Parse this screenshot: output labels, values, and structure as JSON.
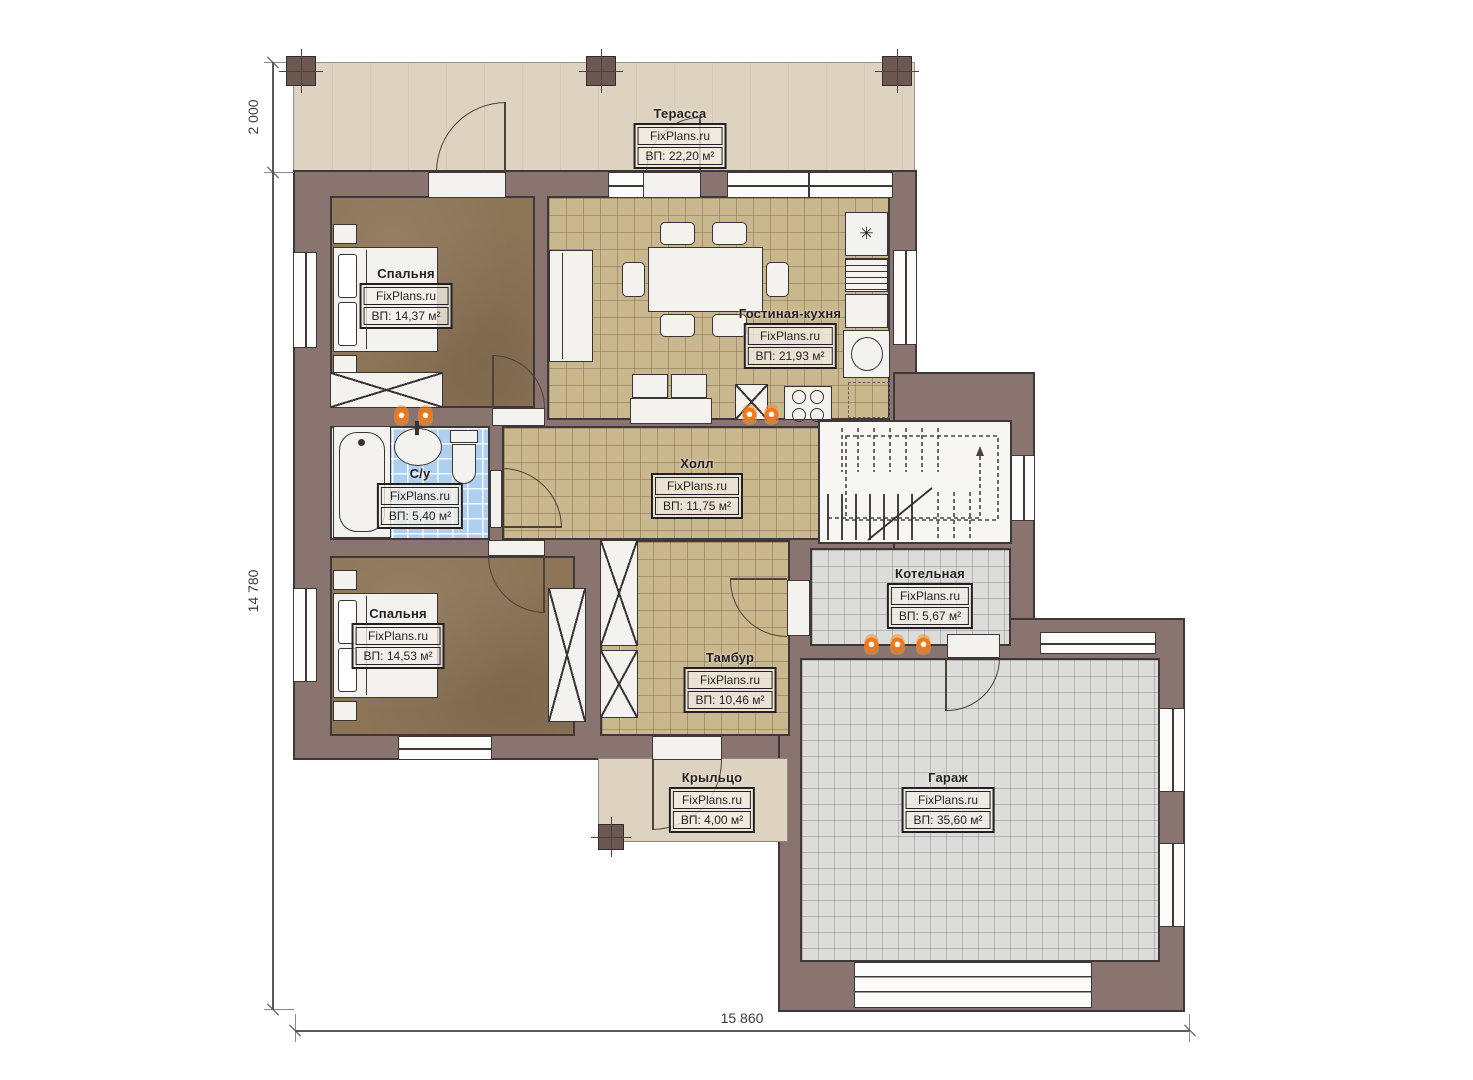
{
  "plan": {
    "type": "floor-plan",
    "language": "ru",
    "brand": "FixPlans.ru"
  },
  "rooms": {
    "terrace": {
      "name": "Терасса",
      "brand": "FixPlans.ru",
      "area": "ВП: 22,20 м²"
    },
    "bedroom1": {
      "name": "Спальня",
      "brand": "FixPlans.ru",
      "area": "ВП: 14,37 м²"
    },
    "living_kitchen": {
      "name": "Гостиная-кухня",
      "brand": "FixPlans.ru",
      "area": "ВП: 21,93 м²"
    },
    "bathroom": {
      "name": "С/у",
      "brand": "FixPlans.ru",
      "area": "ВП: 5,40 м²"
    },
    "hall": {
      "name": "Холл",
      "brand": "FixPlans.ru",
      "area": "ВП: 11,75 м²"
    },
    "bedroom2": {
      "name": "Спальня",
      "brand": "FixPlans.ru",
      "area": "ВП: 14,53 м²"
    },
    "boiler": {
      "name": "Котельная",
      "brand": "FixPlans.ru",
      "area": "ВП: 5,67 м²"
    },
    "vestibule": {
      "name": "Тамбур",
      "brand": "FixPlans.ru",
      "area": "ВП: 10,46 м²"
    },
    "porch": {
      "name": "Крыльцо",
      "brand": "FixPlans.ru",
      "area": "ВП: 4,00 м²"
    },
    "garage": {
      "name": "Гараж",
      "brand": "FixPlans.ru",
      "area": "ВП: 35,60 м²"
    }
  },
  "dimensions": {
    "terrace_depth": "2 000",
    "house_height": "14 780",
    "house_width": "15 860"
  },
  "icons": {
    "fridge_symbol": "✳"
  },
  "colors": {
    "wall": "#8a7470",
    "terrace": "#ded3c0",
    "floor_wood_dark": "#8c7457",
    "floor_tile_tan": "#c9b78e",
    "floor_tile_blue": "#aecff0",
    "floor_tile_gray": "#dcdcda",
    "radiator": "#f07818"
  }
}
